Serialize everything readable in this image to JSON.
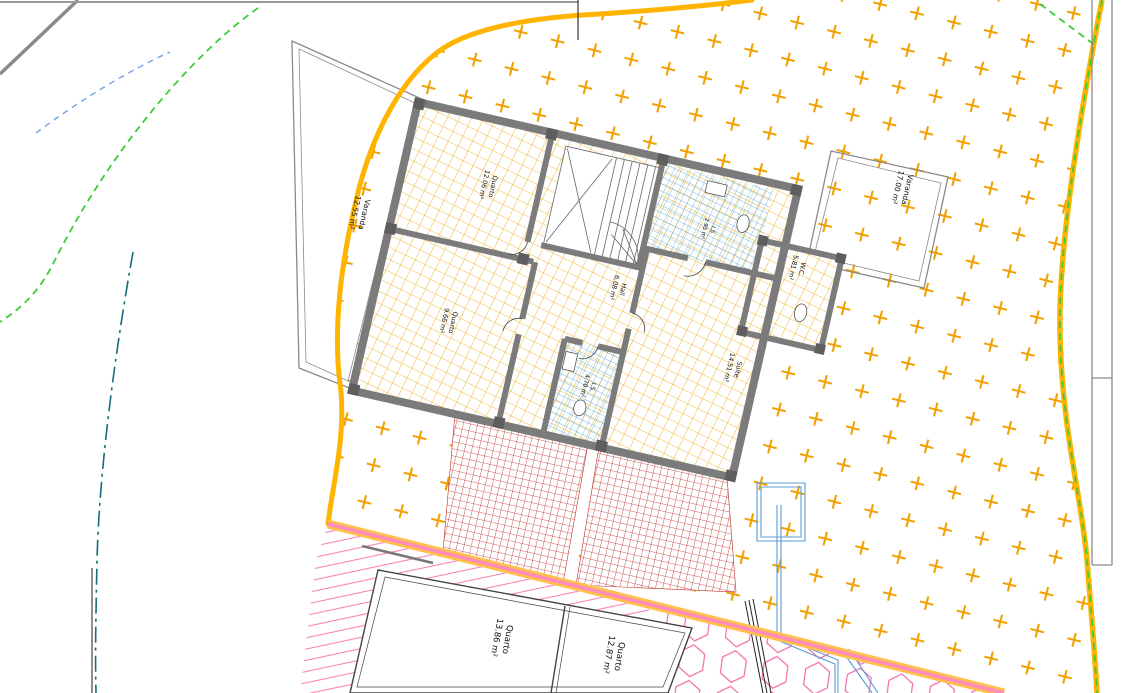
{
  "canvas": {
    "width": 1130,
    "height": 693,
    "description": "CAD site plan with rotated upper-floor house plan on a hatched plot"
  },
  "labels": {
    "varanda_left": {
      "name": "Varanda",
      "area": "12.55 m²"
    },
    "quarto_top": {
      "name": "Quarto",
      "area": "12.06 m²"
    },
    "quarto_bottom": {
      "name": "Quarto",
      "area": "9.66 m²"
    },
    "hall": {
      "name": "Hall",
      "area": "6.08 m²"
    },
    "is_small": {
      "name": "I.S.",
      "area": "2.95 m²"
    },
    "wc": {
      "name": "W.C.",
      "area": "5.81 m²"
    },
    "suite": {
      "name": "Suíte",
      "area": "14.51 m²"
    },
    "is_lower": {
      "name": "I.S.",
      "area": "4.70 m²"
    },
    "varanda_right": {
      "name": "Varanda",
      "area": "17.00 m²"
    },
    "gf_quarto_left": {
      "name": "Quarto",
      "area": "13.86 m²"
    },
    "gf_quarto_right": {
      "name": "Quarto",
      "area": "12.87 m²"
    }
  },
  "colors": {
    "plot_boundary_orange": "#FFB400",
    "plot_hatch_plus": "#F2A000",
    "boundary_dashed_green": "#3BCC3B",
    "boundary_dashed_blue": "#79A9E8",
    "boundary_dashdot_teal": "#196B7E",
    "slab_edge_pink": "#FF8FB0",
    "slab_edge_yellow": "#FFC04D",
    "wall_gray": "#7B7B7B",
    "floor_tile_orange": "#EFA400",
    "wet_area_tile_blue": "#4FA8DC",
    "paving_brick_red": "#C03028",
    "lower_floor_hatch_pink": "#F985B5",
    "terrace_hex_pink": "#F26BA8"
  },
  "hatches": {
    "plot_ground": "orange plus-cross hatch",
    "house_floor": "orange tile grid",
    "wet_areas": "blue tile grid",
    "paving": "red brick grid",
    "lower_floor": "pink diagonal lines",
    "terrace": "pink hexagons"
  }
}
